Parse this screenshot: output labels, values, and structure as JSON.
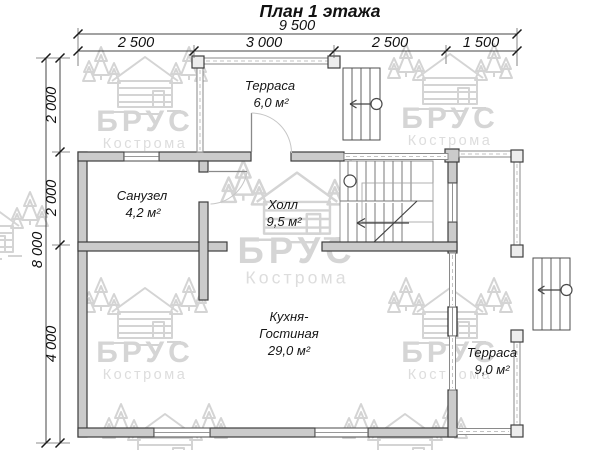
{
  "title": "План 1 этажа",
  "dimensions": {
    "top_total": "9 500",
    "top_segments": [
      "2 500",
      "3 000",
      "2 500",
      "1 500"
    ],
    "left_total": "8 000",
    "left_segments": [
      "2 000",
      "2 000",
      "4 000"
    ]
  },
  "rooms": {
    "terrace_top": {
      "name": "Терраса",
      "area": "6,0 м²"
    },
    "bathroom": {
      "name": "Санузел",
      "area": "4,2 м²"
    },
    "hall": {
      "name": "Холл",
      "area": "9,5 м²"
    },
    "kitchen": {
      "line1": "Кухня-",
      "line2": "Гостиная",
      "area": "29,0 м²"
    },
    "terrace_right": {
      "name": "Терраса",
      "area": "9,0 м²"
    }
  },
  "watermark": {
    "brand": "БРУС",
    "city": "Кострома"
  },
  "colors": {
    "wall_fill": "#cbcbcb",
    "wall_outline": "#3d3d3d",
    "dimension_text": "#111111",
    "watermark_gray": "#d5d5d5"
  }
}
